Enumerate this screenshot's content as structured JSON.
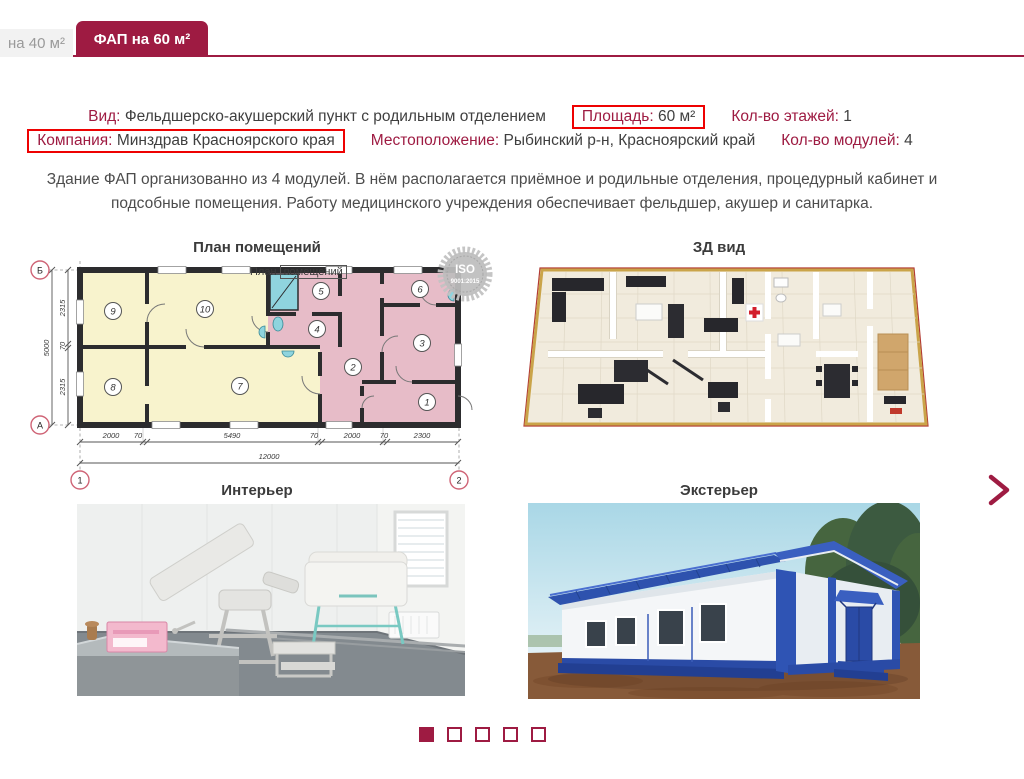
{
  "tabs": [
    {
      "label": "на 40 м²",
      "active": false
    },
    {
      "label": "ФАП на 60 м²",
      "active": true
    }
  ],
  "specs": {
    "row1": [
      {
        "label": "Вид:",
        "value": "Фельдшерско-акушерский пункт с родильным отделением",
        "highlighted": false
      },
      {
        "label": "Площадь:",
        "value": "60 м²",
        "highlighted": true
      },
      {
        "label": "Кол-во этажей:",
        "value": "1",
        "highlighted": false
      }
    ],
    "row2": [
      {
        "label": "Компания:",
        "value": "Минздрав Красноярского края",
        "highlighted": true
      },
      {
        "label": "Местоположение:",
        "value": "Рыбинский р-н, Красноярский край",
        "highlighted": false
      },
      {
        "label": "Кол-во модулей:",
        "value": "4",
        "highlighted": false
      }
    ]
  },
  "description": {
    "line1": "Здание ФАП организованно из 4 модулей. В нём располагается приёмное и родильные отделения, процедурный кабинет и",
    "line2": "подсобные помещения. Работу медицинского учреждения обеспечивает фельдшер, акушер и санитарка."
  },
  "sections": {
    "floor_plan": "План помещений",
    "view_3d": "ЗД вид",
    "interior": "Интерьер",
    "exterior": "Экстерьер"
  },
  "floor_plan": {
    "watermark_part1": "План",
    "watermark_part2": "помещений",
    "iso_line1": "ISO",
    "iso_line2": "9001:2015",
    "rooms": [
      "1",
      "2",
      "3",
      "4",
      "5",
      "6",
      "7",
      "8",
      "9",
      "10"
    ],
    "dims_bottom": [
      "2000",
      "70",
      "5490",
      "70",
      "2000",
      "70",
      "2300"
    ],
    "dim_total_width": "12000",
    "dims_left": [
      "2315",
      "70",
      "2315"
    ],
    "dim_total_height": "5000",
    "axes": {
      "top_left": "Б",
      "bottom_left": "А",
      "col1": "1",
      "col2": "2"
    }
  },
  "carousel": {
    "dots_total": 5,
    "active_index": 0
  },
  "colors": {
    "accent": "#9e1b42",
    "highlight_box": "#ee0101",
    "room_yellow": "#f8f3cd",
    "room_pink": "#e7bcc8"
  }
}
